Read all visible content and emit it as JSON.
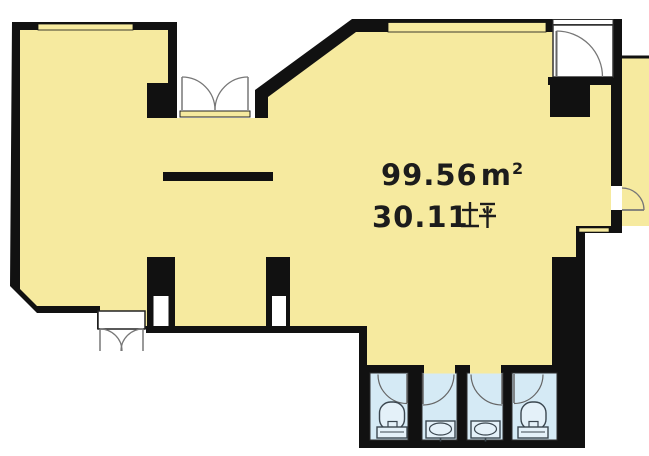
{
  "plan": {
    "title": "floor-plan",
    "area": {
      "sqm_value": "99.56",
      "sqm_unit": "㎡",
      "sqm_unit_m": "m",
      "sqm_unit_exp": "2",
      "tsubo_value": "30.11",
      "tsubo_unit": "坪"
    },
    "colors": {
      "floor": "#f6ea9f",
      "wall": "#111111",
      "wet_area": "#d5eaf5",
      "background": "#ffffff",
      "door_stroke": "#777777",
      "fixture_stroke": "#3b4750"
    },
    "features": {
      "windows": [
        "window-top-left",
        "window-top-right",
        "window-right-step"
      ],
      "doors": [
        "double-door-top",
        "entrance-door-top-right",
        "balcony-door-right",
        "double-door-bottom",
        "stall-door-1",
        "stall-door-2",
        "stall-door-3",
        "stall-door-4"
      ],
      "fixtures": [
        "toilet",
        "sink",
        "sink",
        "toilet"
      ],
      "pillars": [
        "pillar-left",
        "pillar-right",
        "entrance-pillar"
      ],
      "other": [
        "counter-line",
        "service-niche-1",
        "service-niche-2",
        "balcony-strip",
        "restroom-block"
      ]
    }
  }
}
